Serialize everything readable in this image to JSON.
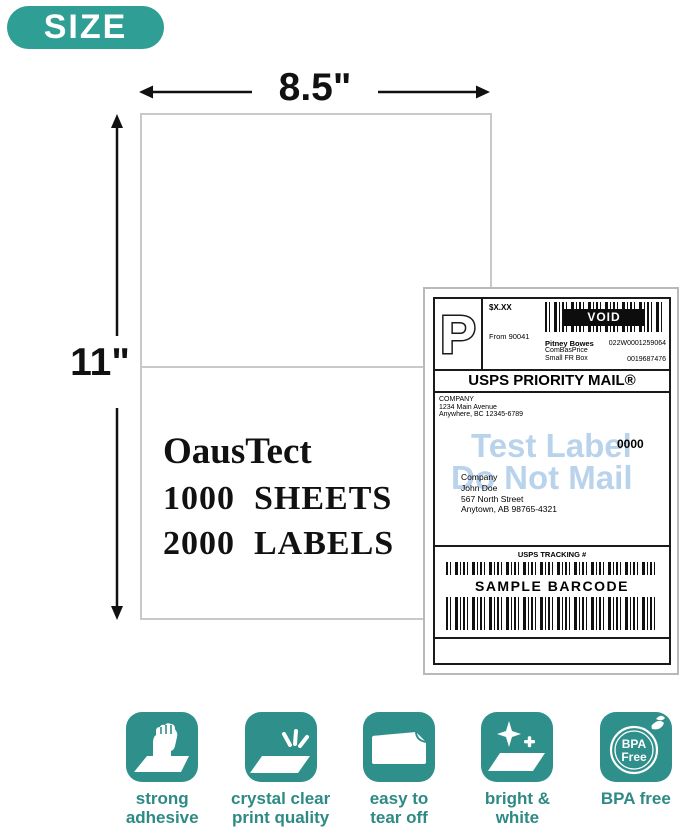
{
  "badge": {
    "label": "SIZE"
  },
  "diagram": {
    "outer_width": "8.5\"",
    "inner_width": "8.5\"",
    "half_height": "5.5\"",
    "outer_height": "11\"",
    "product": {
      "brand": "OausTect",
      "sheets": "1000  SHEETS",
      "labels": "2000  LABELS"
    }
  },
  "label": {
    "p_mark": "P",
    "price": "$X.XX",
    "from": "From 90041",
    "void_text": "VOID",
    "carrier": "Pitney Bowes",
    "rate": "ComBasPrice",
    "box": "Small FR Box",
    "code1": "022W0001259064",
    "code2": "0019687476",
    "service": "USPS PRIORITY MAIL®",
    "sender": [
      "COMPANY",
      "1234 Main Avenue",
      "Anywhere, BC 12345-6789"
    ],
    "watermark1": "Test Label",
    "watermark2": "Do Not Mail",
    "zip": "0000",
    "recipient": [
      "Company",
      "John Doe",
      "567 North Street",
      "Anytown, AB 98765-4321"
    ],
    "tracking_header": "USPS TRACKING #",
    "barcode_caption": "SAMPLE BARCODE"
  },
  "features": [
    {
      "icon": "fist-adhesive-icon",
      "line1": "strong",
      "line2": "adhesive"
    },
    {
      "icon": "sparkle-sheet-icon",
      "line1": "crystal clear",
      "line2": "print quality"
    },
    {
      "icon": "tear-off-sheet-icon",
      "line1": "easy to",
      "line2": "tear off"
    },
    {
      "icon": "bright-sheet-icon",
      "line1": "bright &",
      "line2": "white"
    },
    {
      "icon": "bpa-free-circle-icon",
      "line1": "BPA free",
      "line2": "",
      "icon_text1": "BPA",
      "icon_text2": "Free"
    }
  ],
  "colors": {
    "badge_teal": "#2f9e95",
    "icon_teal": "#2f8f8b",
    "feature_text_teal": "#2e8a84",
    "arrow_blue": "#79a7da",
    "watermark_blue": "#b9d3ec"
  }
}
